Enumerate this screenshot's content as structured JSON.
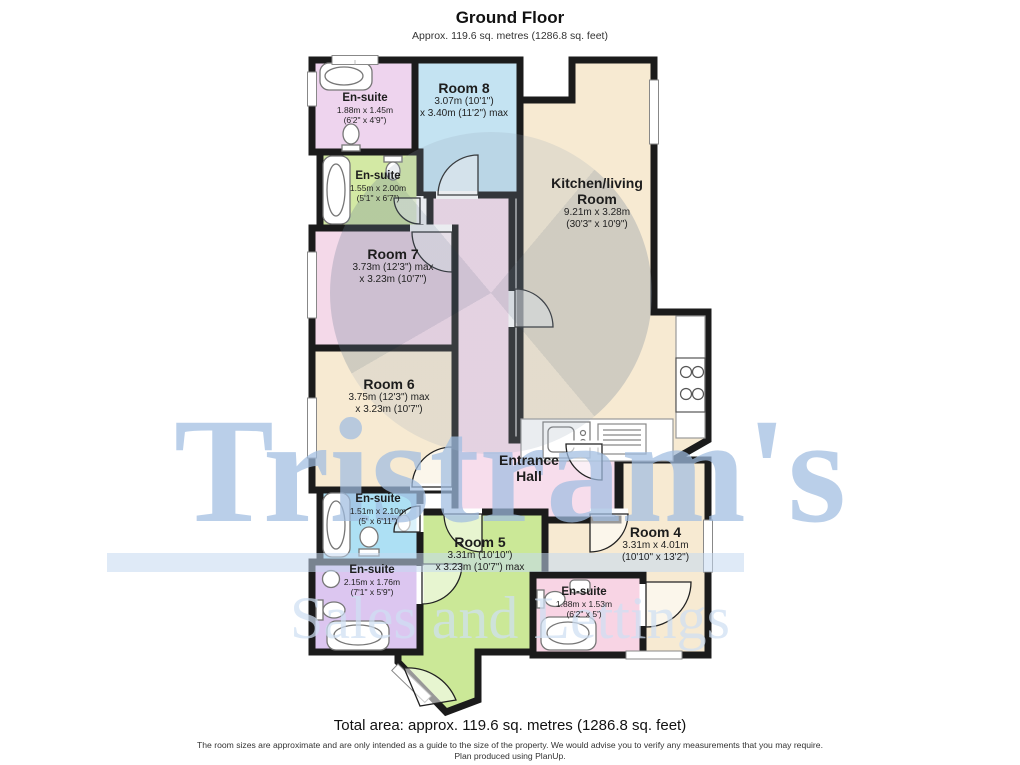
{
  "header": {
    "title": "Ground Floor",
    "subtitle": "Approx. 119.6 sq. metres (1286.8 sq. feet)"
  },
  "rooms": {
    "room8": {
      "name": "Room 8",
      "dim1": "3.07m (10'1\")",
      "dim2": "x 3.40m (11'2\") max"
    },
    "kitchen": {
      "name": "Kitchen/living",
      "name2": "Room",
      "dim1": "9.21m x 3.28m",
      "dim2": "(30'3\" x 10'9\")"
    },
    "room7": {
      "name": "Room 7",
      "dim1": "3.73m (12'3\") max",
      "dim2": "x 3.23m (10'7\")"
    },
    "room6": {
      "name": "Room 6",
      "dim1": "3.75m (12'3\") max",
      "dim2": "x 3.23m (10'7\")"
    },
    "hall": {
      "name": "Entrance",
      "name2": "Hall"
    },
    "room5": {
      "name": "Room 5",
      "dim1": "3.31m (10'10\")",
      "dim2": "x 3.23m (10'7\") max"
    },
    "room4": {
      "name": "Room 4",
      "dim1": "3.31m x 4.01m",
      "dim2": "(10'10\" x 13'2\")"
    },
    "ensuite1": {
      "name": "En-suite",
      "dim1": "1.88m x 1.45m",
      "dim2": "(6'2\" x 4'9\")"
    },
    "ensuite2": {
      "name": "En-suite",
      "dim1": "1.55m x 2.00m",
      "dim2": "(5'1\" x 6'7\")"
    },
    "ensuite3": {
      "name": "En-suite",
      "dim1": "1.51m x 2.10m",
      "dim2": "(5' x 6'11\")"
    },
    "ensuite4": {
      "name": "En-suite",
      "dim1": "2.15m x 1.76m",
      "dim2": "(7'1\" x 5'9\")"
    },
    "ensuite5": {
      "name": "En-suite",
      "dim1": "1.88m x 1.53m",
      "dim2": "(6'2\" x 5')"
    }
  },
  "watermark": {
    "brand": "Tristram's",
    "tagline": "Sales and Lettings"
  },
  "footer": {
    "total": "Total area: approx. 119.6 sq. metres (1286.8 sq. feet)",
    "disclaimer": "The room sizes are approximate and are only intended as a guide to the size of the property. We would advise you to verify any measurements that you may require.",
    "produced": "Plan produced using PlanUp."
  },
  "colors": {
    "wall": "#1b1b1b",
    "cream": "#f7ead2",
    "blue_room": "#c4e3f2",
    "pink_room": "#f4d9e9",
    "hall_pink": "#f7ddec",
    "green_room": "#cbe897",
    "ensuite1": "#eed4ee",
    "ensuite2": "#d3e9a4",
    "ensuite3": "#ade0f4",
    "ensuite4": "#dcc6f0",
    "ensuite5": "#f8d4e4",
    "watermark_blue": "#a8c2e2"
  }
}
